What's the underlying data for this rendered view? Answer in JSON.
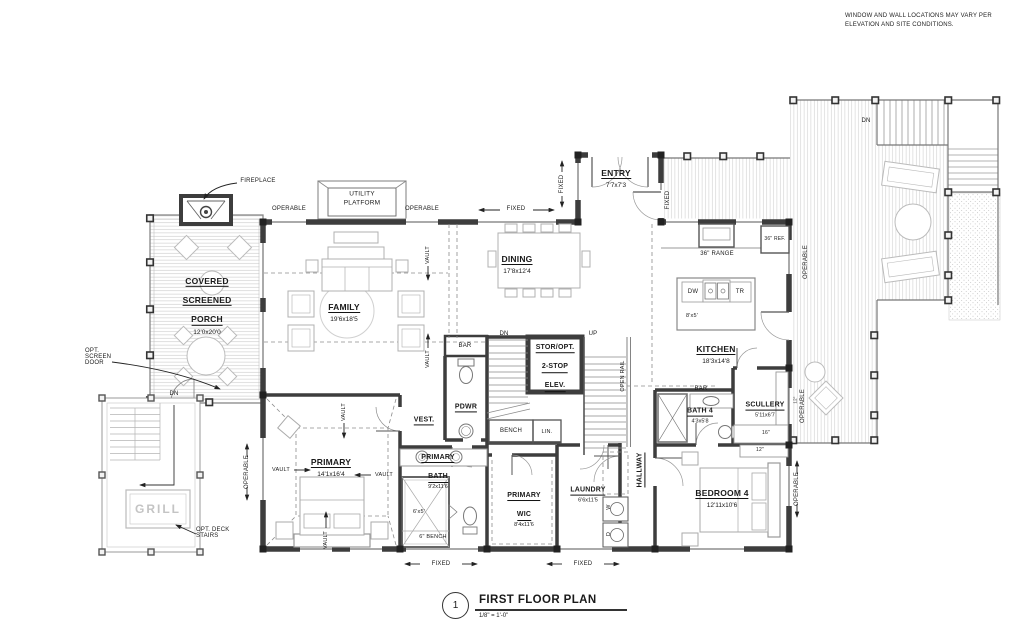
{
  "note": {
    "line1": "WINDOW AND WALL LOCATIONS MAY VARY PER",
    "line2": "ELEVATION AND SITE CONDITIONS."
  },
  "title_block": {
    "number": "1",
    "title": "FIRST FLOOR PLAN",
    "scale": "1/8\" = 1'-0\""
  },
  "rooms": {
    "porch": {
      "name_lines": [
        "COVERED",
        "SCREENED",
        "PORCH"
      ],
      "dims": "12'0x20'0"
    },
    "family": {
      "name_lines": [
        "FAMILY"
      ],
      "dims": "19'6x18'5"
    },
    "dining": {
      "name_lines": [
        "DINING"
      ],
      "dims": "17'8x12'4"
    },
    "entry": {
      "name_lines": [
        "ENTRY"
      ],
      "dims": "7'7x7'3"
    },
    "kitchen": {
      "name_lines": [
        "KITCHEN"
      ],
      "dims": "18'3x14'8"
    },
    "elevator": {
      "name_lines": [
        "STOR/OPT.",
        "2-STOP",
        "ELEV."
      ],
      "dims": ""
    },
    "powder": {
      "name_lines": [
        "PDWR"
      ],
      "dims": ""
    },
    "vestibule": {
      "name_lines": [
        "VEST."
      ],
      "dims": ""
    },
    "primary": {
      "name_lines": [
        "PRIMARY"
      ],
      "dims": "14'1x16'4"
    },
    "primary_bath": {
      "name_lines": [
        "PRIMARY",
        "BATH"
      ],
      "dims": "9'2x11'6"
    },
    "primary_wic": {
      "name_lines": [
        "PRIMARY",
        "WIC"
      ],
      "dims": "8'4x11'6"
    },
    "laundry": {
      "name_lines": [
        "LAUNDRY"
      ],
      "dims": "6'6x11'5"
    },
    "hallway": {
      "name_lines": [
        "HALLWAY"
      ],
      "dims": ""
    },
    "bedroom4": {
      "name_lines": [
        "BEDROOM 4"
      ],
      "dims": "12'11x10'6"
    },
    "bath4": {
      "name_lines": [
        "BATH 4"
      ],
      "dims": "4'3x5'8"
    },
    "scullery": {
      "name_lines": [
        "SCULLERY"
      ],
      "dims": "5'11x6'7"
    }
  },
  "annotations": {
    "fireplace": "FIREPLACE",
    "utility_line1": "UTILITY",
    "utility_line2": "PLATFORM",
    "operable": "OPERABLE",
    "fixed": "FIXED",
    "vault": "VAULT",
    "dn": "DN",
    "up": "UP",
    "bar": "BAR",
    "bench": "BENCH",
    "linen": "LIN.",
    "open_rail": "OPEN RAIL",
    "bench_6": "6\" BENCH",
    "shower_size": "6'x5'",
    "opt_screen_door_lines": [
      "OPT.",
      "SCREEN",
      "DOOR"
    ],
    "opt_deck_stairs_lines": [
      "OPT. DECK",
      "STAIRS"
    ],
    "grill": "GRILL",
    "range": "36\" RANGE",
    "fridge": "36\" REF.",
    "dishwasher": "DW",
    "trash": "TR",
    "island_size": "8'x5'",
    "washer": "W",
    "dryer": "D",
    "dim_16": "16\"",
    "dim_12": "12\""
  },
  "colors": {
    "wall": "#3d3d3d",
    "annotation": "#1a1a1a",
    "furniture": "#aaaaaa",
    "deck_hatch": "#cccccc"
  }
}
